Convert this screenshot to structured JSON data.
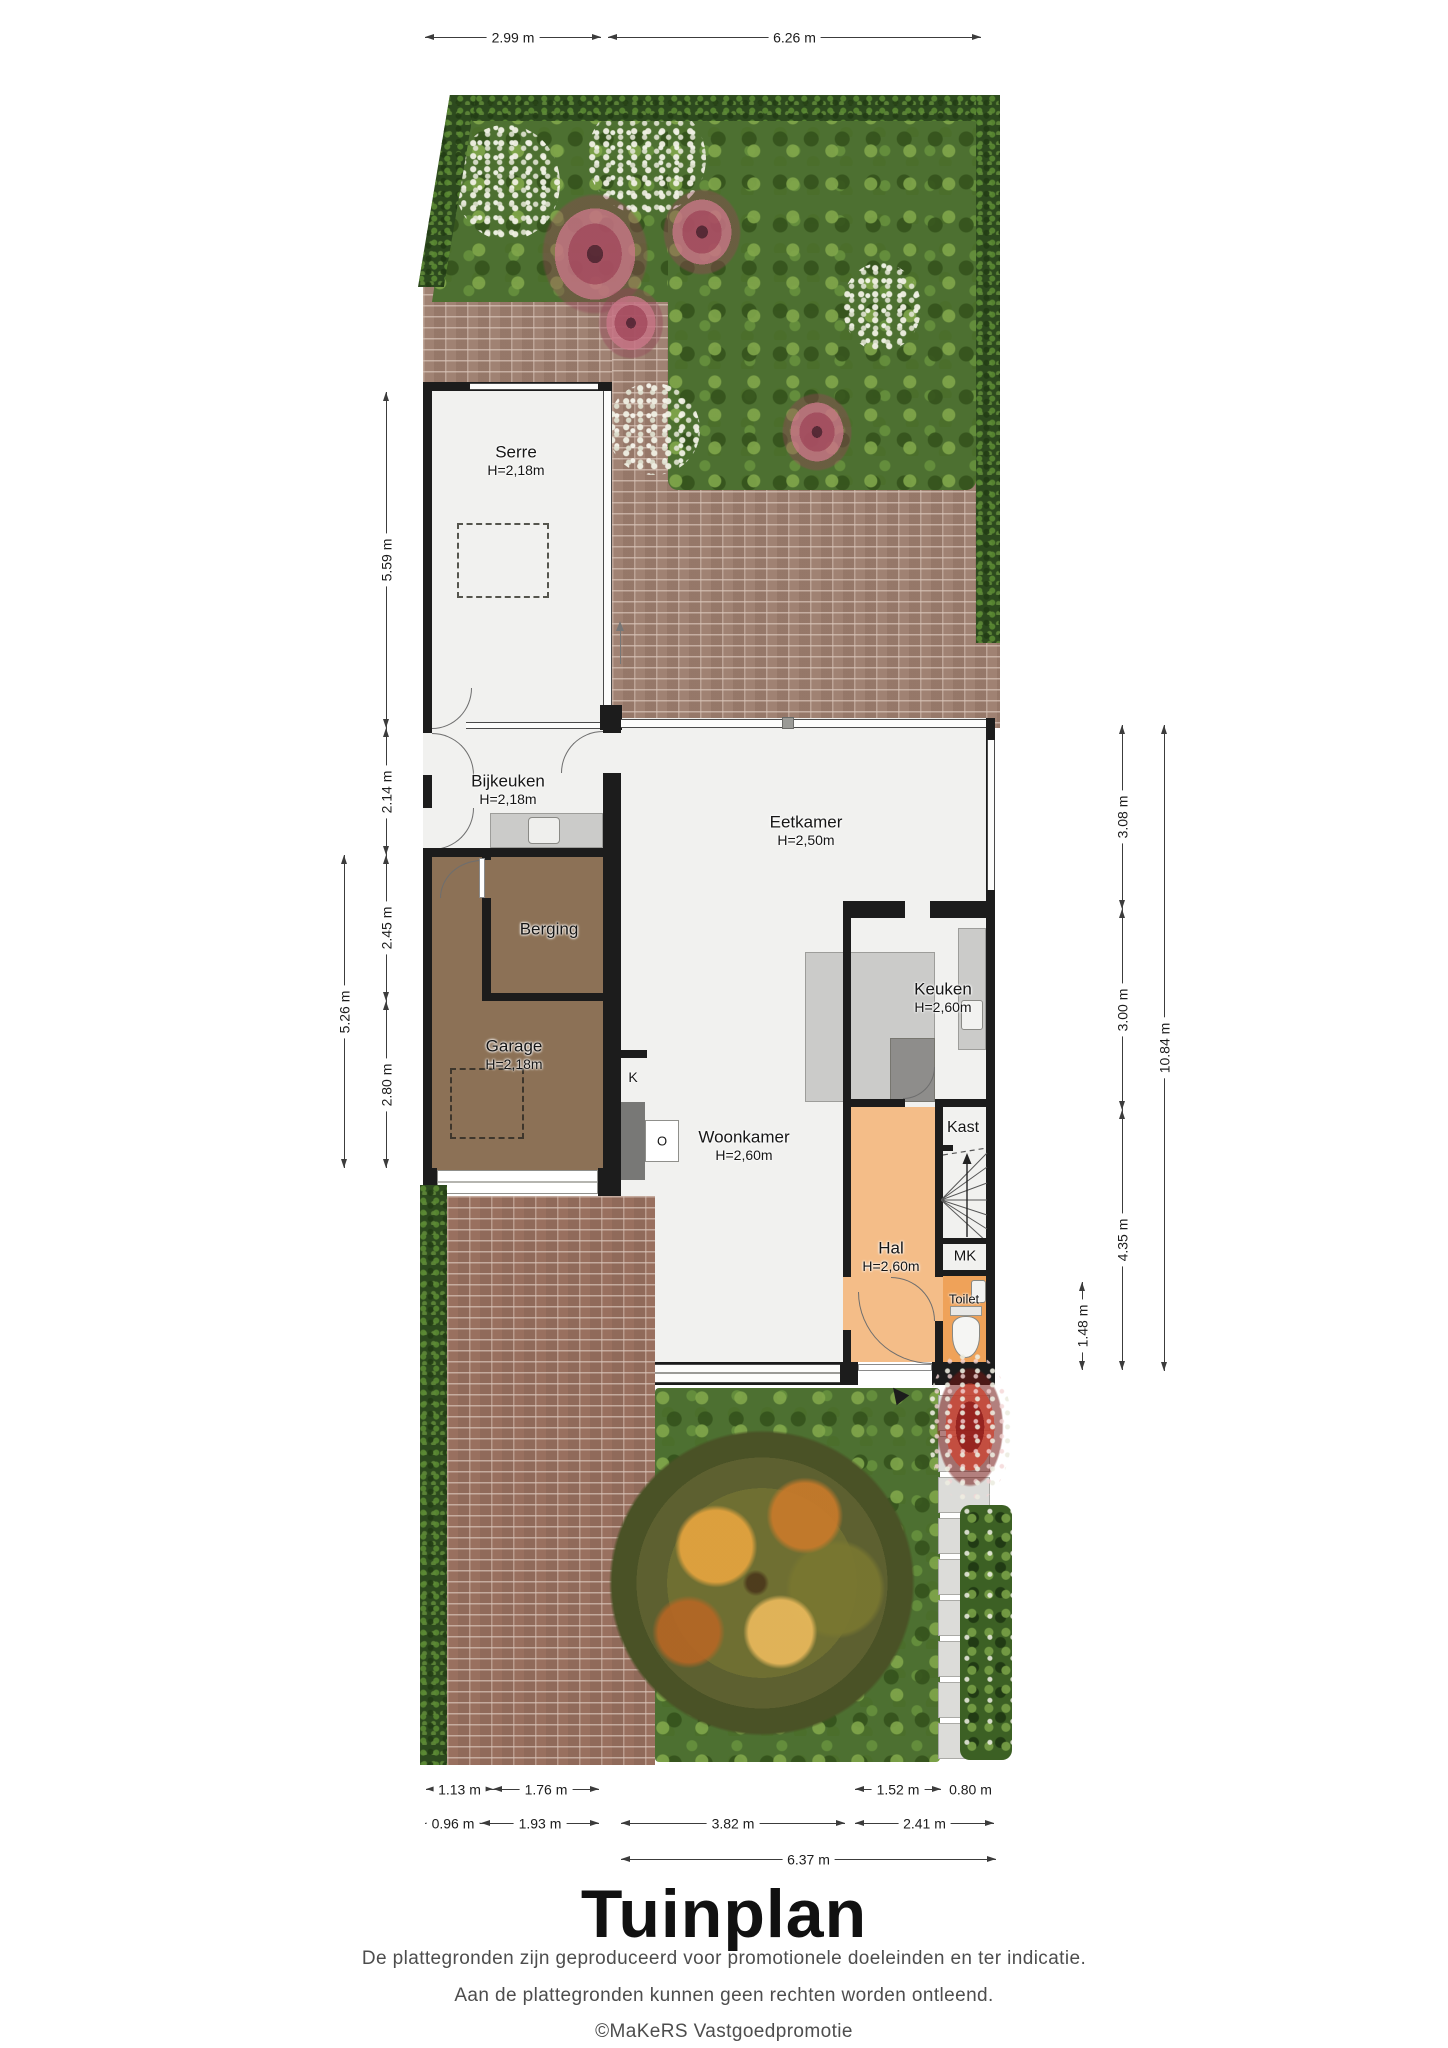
{
  "title": "Tuinplan",
  "footer": {
    "line1": "De plattegronden zijn geproduceerd voor promotionele doeleinden en ter indicatie.",
    "line2": "Aan de plattegronden kunnen geen rechten worden ontleend.",
    "line3": "©MaKeRS Vastgoedpromotie"
  },
  "rooms": {
    "serre": {
      "name": "Serre",
      "h": "H=2,18m"
    },
    "bijkeuken": {
      "name": "Bijkeuken",
      "h": "H=2,18m"
    },
    "eetkamer": {
      "name": "Eetkamer",
      "h": "H=2,50m"
    },
    "berging": {
      "name": "Berging"
    },
    "garage": {
      "name": "Garage",
      "h": "H=2,18m"
    },
    "keuken": {
      "name": "Keuken",
      "h": "H=2,60m"
    },
    "woonkamer": {
      "name": "Woonkamer",
      "h": "H=2,60m"
    },
    "hal": {
      "name": "Hal",
      "h": "H=2,60m"
    },
    "kast": {
      "name": "Kast"
    },
    "mk": {
      "name": "MK"
    },
    "toilet": {
      "name": "Toilet"
    },
    "k": {
      "name": "K"
    },
    "o": {
      "name": "O"
    }
  },
  "dims": {
    "top": [
      "2.99 m",
      "6.26 m"
    ],
    "left": [
      "5.59 m",
      "2.14 m",
      "2.45 m",
      "2.80 m",
      "5.26 m"
    ],
    "right": [
      "3.08 m",
      "3.00 m",
      "4.35 m",
      "1.48 m",
      "10.84 m"
    ],
    "b1": [
      "1.13 m",
      "1.76 m",
      "1.52 m",
      "0.80 m"
    ],
    "b2": [
      "0.96 m",
      "1.93 m",
      "3.82 m",
      "2.41 m"
    ],
    "b3": [
      "6.37 m"
    ]
  },
  "colors": {
    "wall": "#1c1c1c",
    "room_floor": "#f1f1ef",
    "garage_brown": "#8c7156",
    "hal_orange": "#f4bd88",
    "toilet_orange": "#efa259",
    "hedge_green": "#2d4a1e",
    "bed_green": "#4d7031",
    "brick_patio": "#a08273",
    "brick_drive": "#99705f",
    "counter_gray": "#cbcbc9"
  }
}
